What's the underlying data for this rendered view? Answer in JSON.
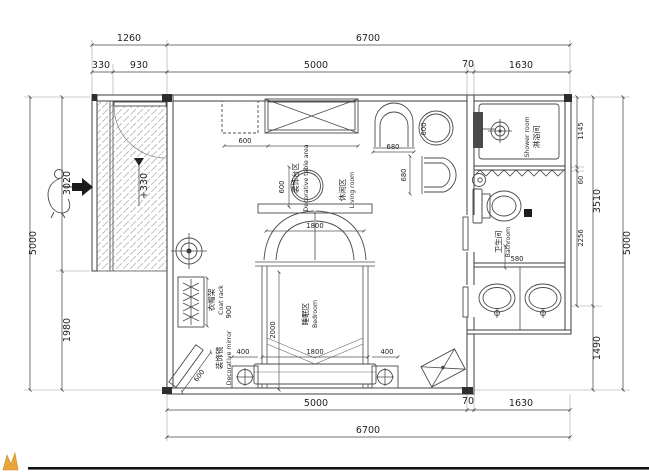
{
  "plan": {
    "rooms": {
      "decorative_table": {
        "zh": "装饰台区",
        "en": "Decorative table area"
      },
      "living": {
        "zh": "休闲区",
        "en": "Living room"
      },
      "bedroom": {
        "zh": "睡眠区",
        "en": "Bedroom"
      },
      "shower": {
        "zh": "淋浴间",
        "en": "Shower room"
      },
      "bathroom": {
        "zh": "卫生间",
        "en": "Bathroom"
      },
      "coat_rack": {
        "zh": "衣帽架",
        "en": "Coat rack"
      },
      "mirror": {
        "zh": "装饰镜",
        "en": "Decorative mirror"
      }
    },
    "levels": {
      "entry": "+330"
    },
    "dims": {
      "top": {
        "d1260": "1260",
        "d6700": "6700",
        "d330": "330",
        "d930": "930",
        "d5000": "5000",
        "d70": "70",
        "d1630": "1630"
      },
      "left": {
        "d5000": "5000",
        "d3020": "3020",
        "d1980": "1980"
      },
      "right": {
        "d1145": "1145",
        "d60": "60",
        "d2256": "2256",
        "d3510": "3510",
        "d1490": "1490",
        "d5000": "5000"
      },
      "bottom": {
        "d5000": "5000",
        "d70": "70",
        "d1630": "1630",
        "d6700": "6700"
      },
      "furniture": {
        "cabinet": "600",
        "living_table": "600",
        "chair_w": "680",
        "chair_h": "680",
        "side_table": "600",
        "bed_head": "1800",
        "bed_len": "2000",
        "bed_foot": "1800",
        "nightstand_l": "400",
        "nightstand_r": "400",
        "coat_rack_len": "900",
        "mirror_len": "600",
        "vanity": "580"
      }
    },
    "colors": {
      "line": "#3c3c3c",
      "accent": "#e9a63b"
    }
  }
}
